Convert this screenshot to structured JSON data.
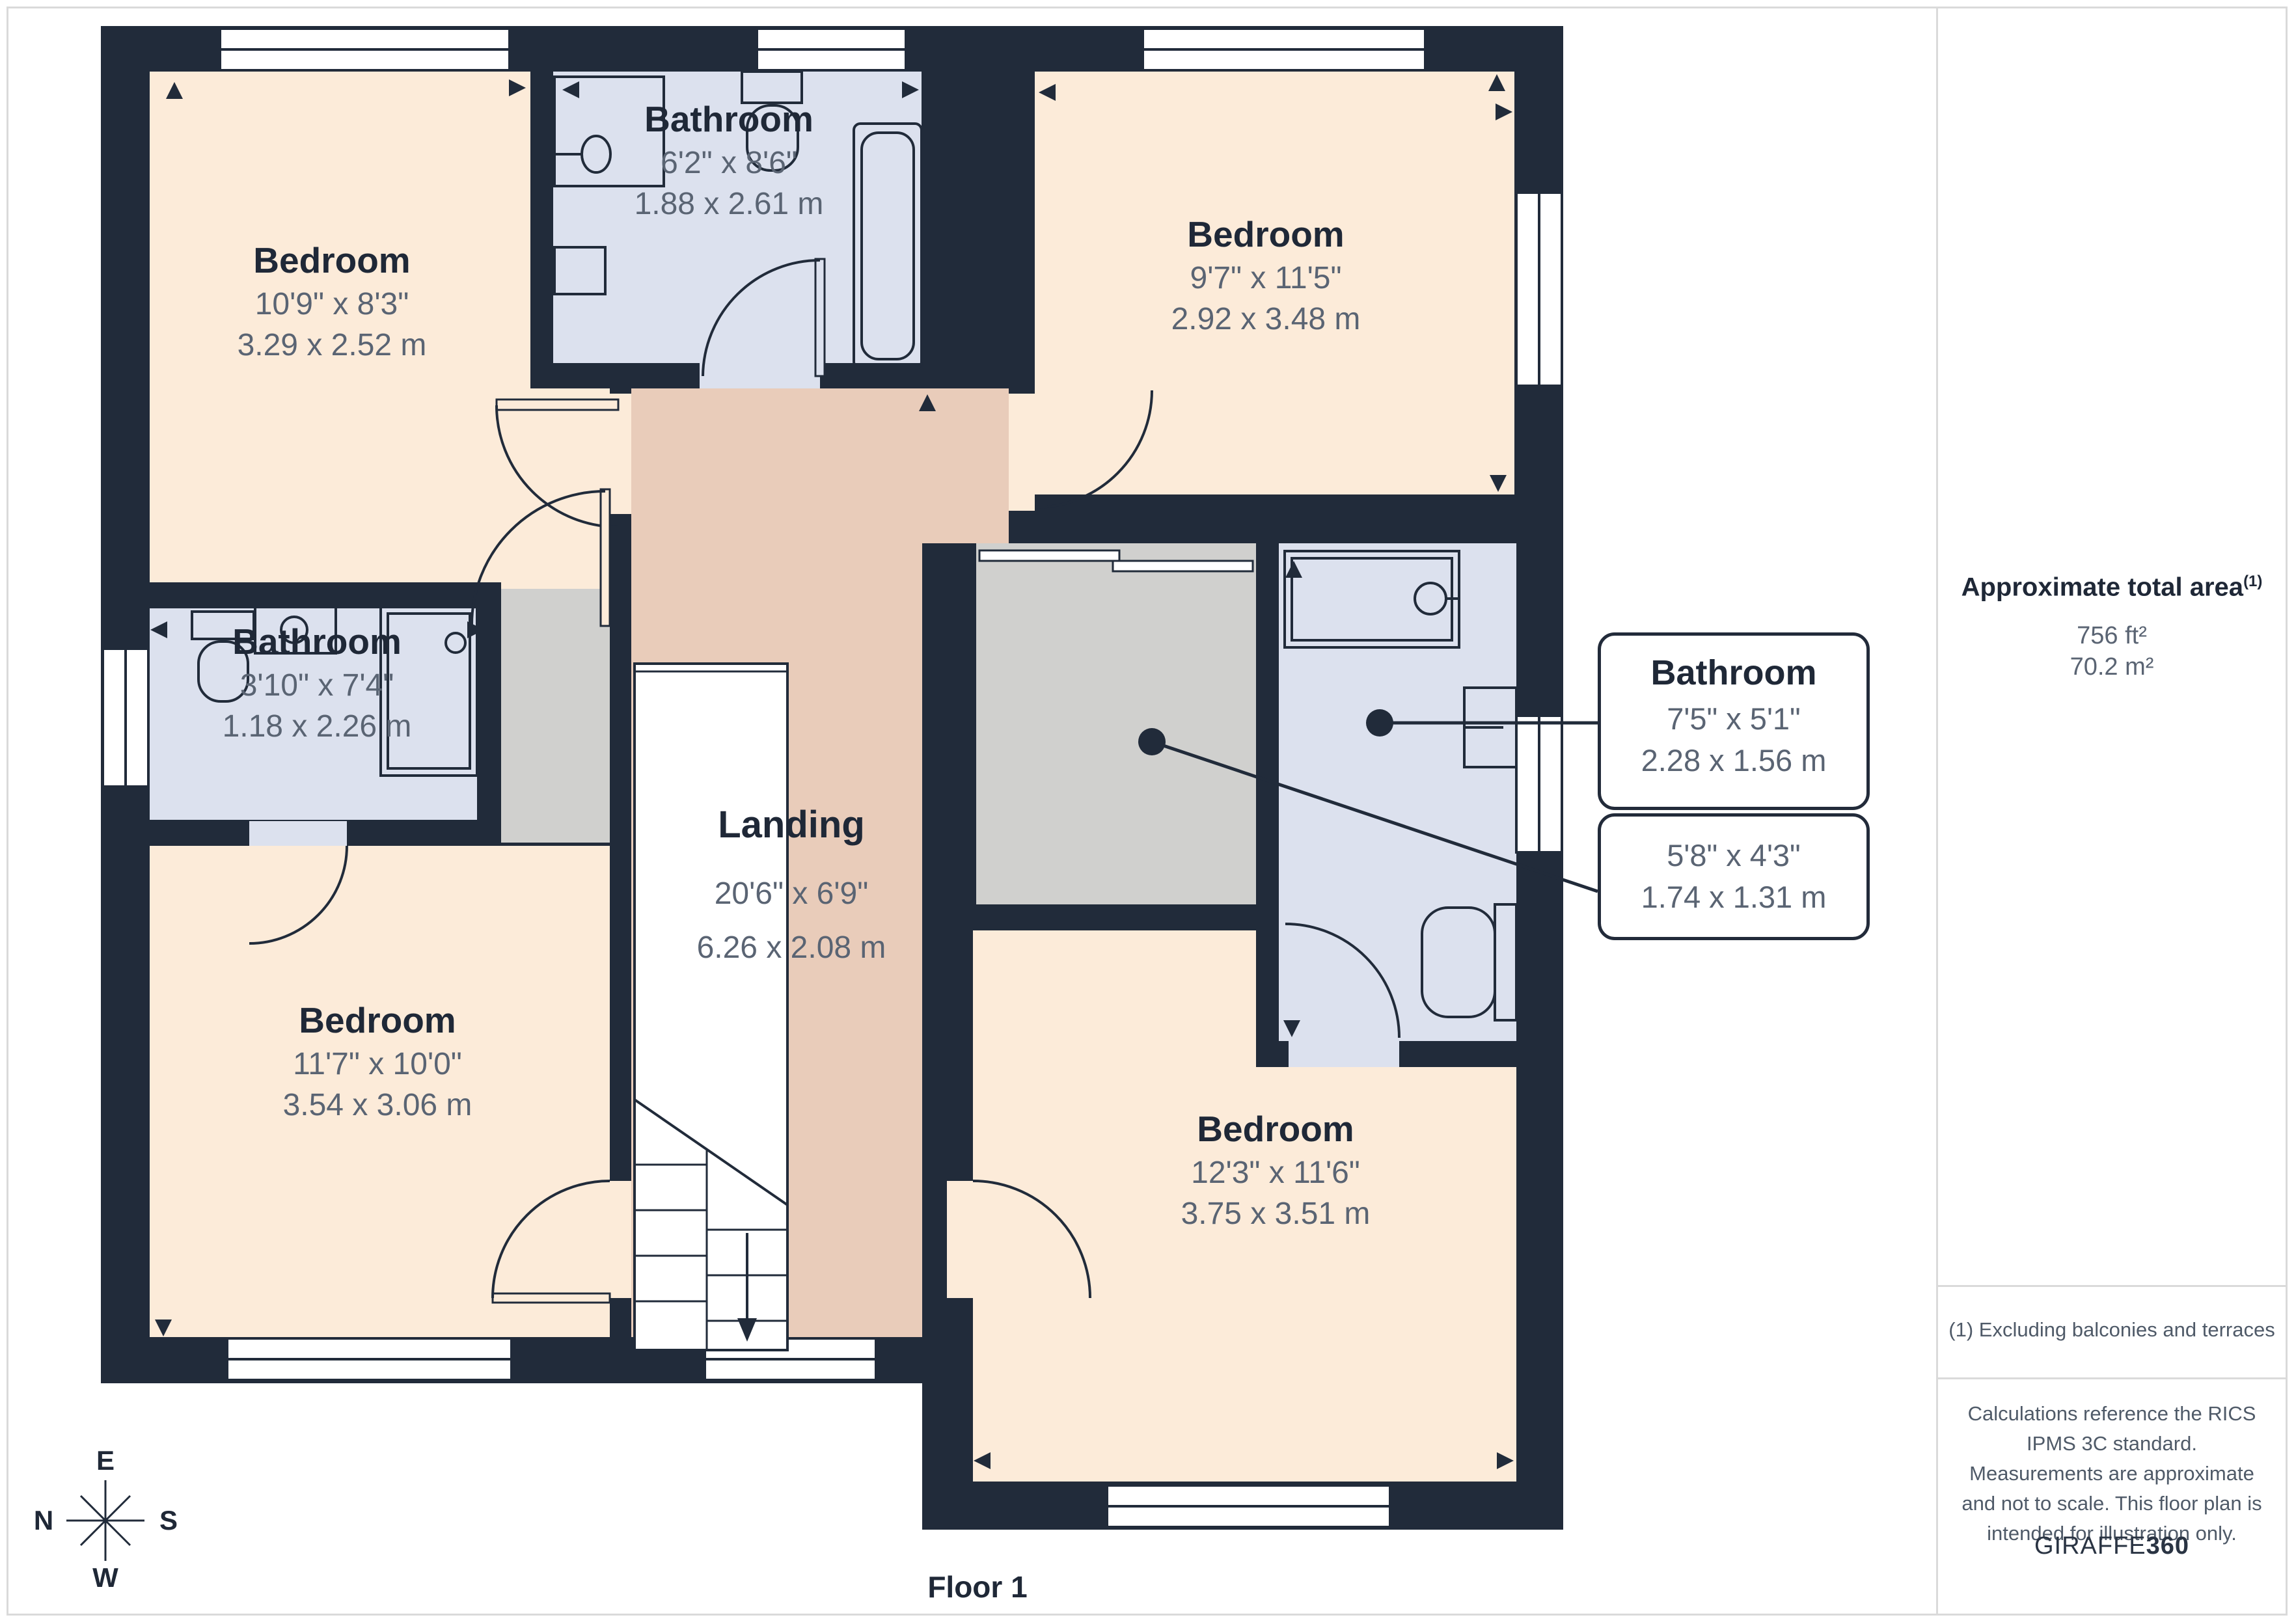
{
  "page": {
    "floor_label": "Floor 1"
  },
  "compass": {
    "n": "N",
    "e": "E",
    "s": "S",
    "w": "W"
  },
  "rooms": {
    "tl_bedroom": {
      "name": "Bedroom",
      "imperial": "10'9\" x 8'3\"",
      "metric": "3.29 x 2.52 m"
    },
    "top_bathroom": {
      "name": "Bathroom",
      "imperial": "6'2\" x 8'6\"",
      "metric": "1.88 x 2.61 m"
    },
    "tr_bedroom": {
      "name": "Bedroom",
      "imperial": "9'7\" x 11'5\"",
      "metric": "2.92 x 3.48 m"
    },
    "left_bathroom": {
      "name": "Bathroom",
      "imperial": "3'10\" x 7'4\"",
      "metric": "1.18 x 2.26 m"
    },
    "landing": {
      "name": "Landing",
      "imperial": "20'6\" x 6'9\"",
      "metric": "6.26 x 2.08 m"
    },
    "bl_bedroom": {
      "name": "Bedroom",
      "imperial": "11'7\" x 10'0\"",
      "metric": "3.54 x 3.06 m"
    },
    "br_bedroom": {
      "name": "Bedroom",
      "imperial": "12'3\" x 11'6\"",
      "metric": "3.75 x 3.51 m"
    }
  },
  "callouts": {
    "bathroom": {
      "name": "Bathroom",
      "imperial": "7'5\" x 5'1\"",
      "metric": "2.28 x 1.56 m"
    },
    "closet": {
      "imperial": "5'8\" x 4'3\"",
      "metric": "1.74 x 1.31 m"
    }
  },
  "sidebar": {
    "area_title": "Approximate total area",
    "area_footnote_marker": "(1)",
    "area_imperial": "756 ft²",
    "area_metric": "70.2 m²",
    "footnote": "(1) Excluding balconies and terraces",
    "disclaimer": "Calculations reference the RICS IPMS 3C standard. Measurements are approximate and not to scale. This floor plan is intended for illustration only.",
    "brand_prefix": "GIRAFFE",
    "brand_suffix": "360"
  },
  "colors": {
    "wall": "#212B3A",
    "bedroom_fill": "#FCEBD9",
    "bathroom_fill": "#DCE1EE",
    "landing_fill": "#E9CCBA",
    "closet_fill": "#D0D0CE",
    "name_text": "#1F2837",
    "dim_text": "#5A6473",
    "border_gray": "#DADADA"
  }
}
